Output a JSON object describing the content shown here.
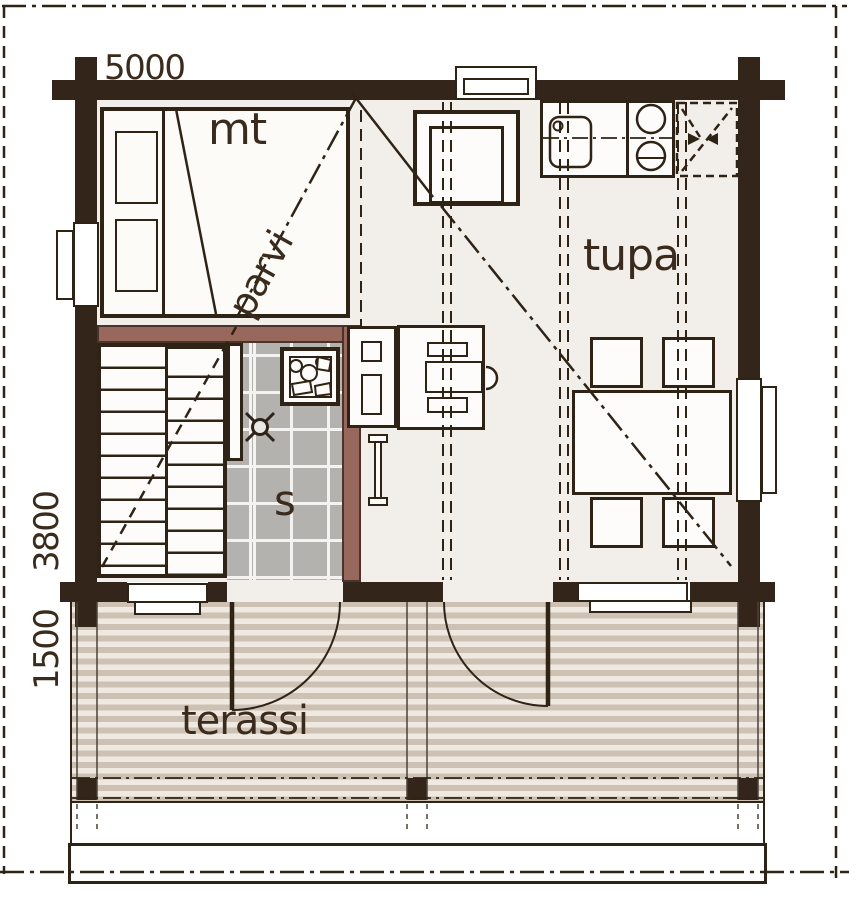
{
  "labels": {
    "bedroom": "mt",
    "loft": "parvi",
    "living": "tupa",
    "sauna": "s",
    "terrace": "terassi"
  },
  "dimensions": {
    "width": "5000",
    "main_depth": "3800",
    "terrace_depth": "1500"
  },
  "icons": {
    "sauna_heater": "sauna-heater-stones",
    "floor_drain": "floor-drain-cross",
    "fridge_reservation": "dashed-reservation-arrows",
    "sink": "kitchen-sink",
    "stove": "two-burner-stove"
  },
  "colors": {
    "wall": "#33251a",
    "sauna_wall": "#97685b",
    "tile": "#b4b2af",
    "deck_stripe": "#cdc1b4",
    "floor": "#f2efeb",
    "line": "#2f2316",
    "text": "#3a2b1c"
  }
}
